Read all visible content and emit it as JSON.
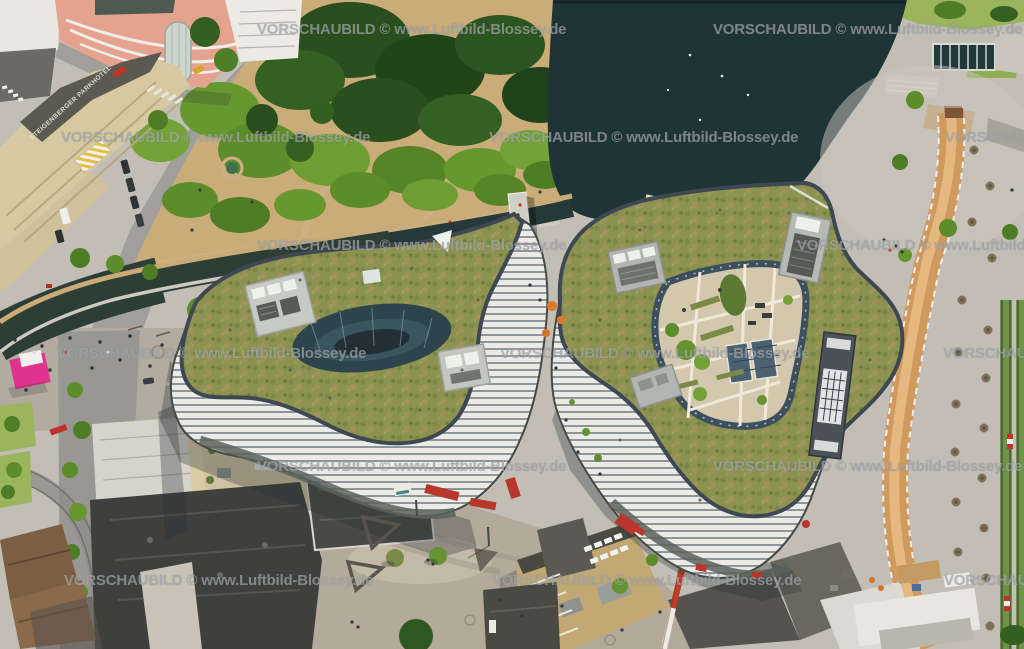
{
  "watermark": {
    "text": "VORSCHAUBILD © www.Luftbild-Blossey.de",
    "color": "#adb0b3",
    "opacity": 0.62
  },
  "labels": {
    "hotel_roof_text": "STEIGENBERGER PARKHOTEL"
  },
  "palette": {
    "water_pond": "#1f3437",
    "water_channel": "#2c3e35",
    "park_dirt": "#c9ac78",
    "lawn": "#9ab55c",
    "tree_dark": "#2a4e1d",
    "tree_mid": "#4e7d26",
    "tree_bright": "#74a238",
    "sedum_roof": "#8c9350",
    "sedum_brown": "#a0925a",
    "roof_edge": "#3f4852",
    "terrace": "#d3c7ae",
    "courtyard_glass": "#2d444c",
    "facade_light": "#eceae5",
    "facade_line": "#8e969d",
    "plaza": "#b4aa9a",
    "pavement": "#c2beb6",
    "street": "#9e9d99",
    "hotel_cream": "#d6c8a0",
    "hotel_roof_dark": "#5a5a50",
    "pink_building": "#e5a28f",
    "kiosk_pink": "#e0338c",
    "crane_red": "#c23a28",
    "construction_path": "#d09a5e",
    "tram_green": "#6d9348",
    "dark_roof": "#3f403e",
    "brown_roof": "#7c5f43",
    "red_accent": "#b03028",
    "deck_wood": "#c59a63",
    "weir_dark": "#22393c",
    "white_building": "#e6e3dd",
    "parking_roof_tan": "#c2a873",
    "hvac_gray": "#b9bcb8"
  }
}
